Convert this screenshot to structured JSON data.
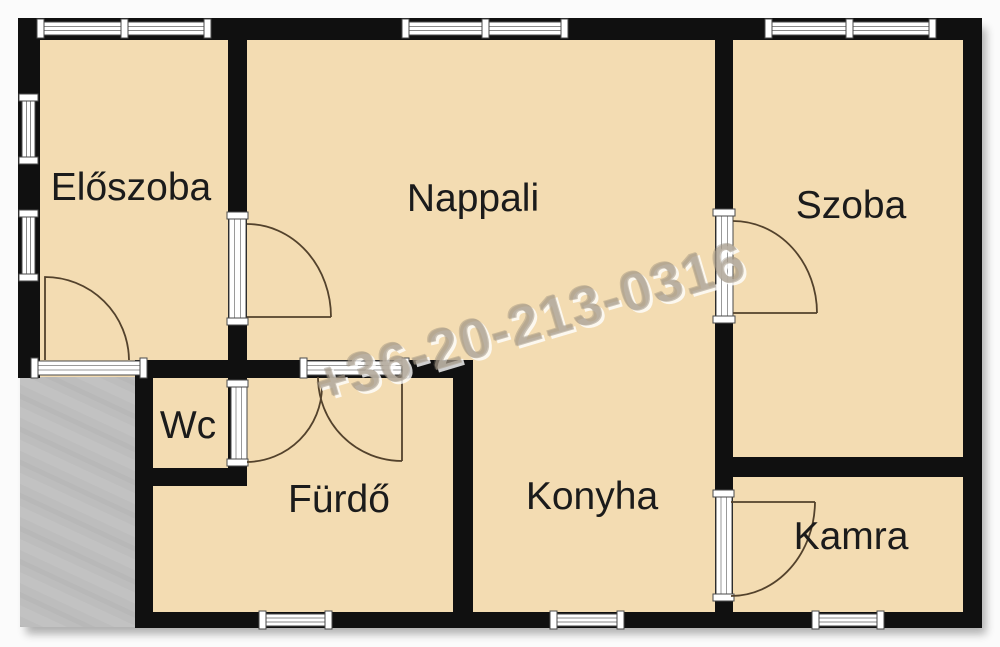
{
  "floorplan": {
    "rooms": {
      "eloszoba": {
        "label": "Előszoba"
      },
      "nappali": {
        "label": "Nappali"
      },
      "szoba": {
        "label": "Szoba"
      },
      "wc": {
        "label": "Wc"
      },
      "furdo": {
        "label": "Fürdő"
      },
      "konyha": {
        "label": "Konyha"
      },
      "kamra": {
        "label": "Kamra"
      }
    },
    "watermark": {
      "text": "+36-20-213-0316"
    },
    "colors": {
      "background": "#fbfbfb",
      "room_fill": "#f3dcb2",
      "wall": "#101010",
      "terrace": "#bdbdbd",
      "door_arc": "#53422c",
      "label_text": "#1b1b1b",
      "watermark_fill": "#ab9f8e",
      "window_frame": "#4a4a4a",
      "window_glass": "#ffffff"
    }
  }
}
